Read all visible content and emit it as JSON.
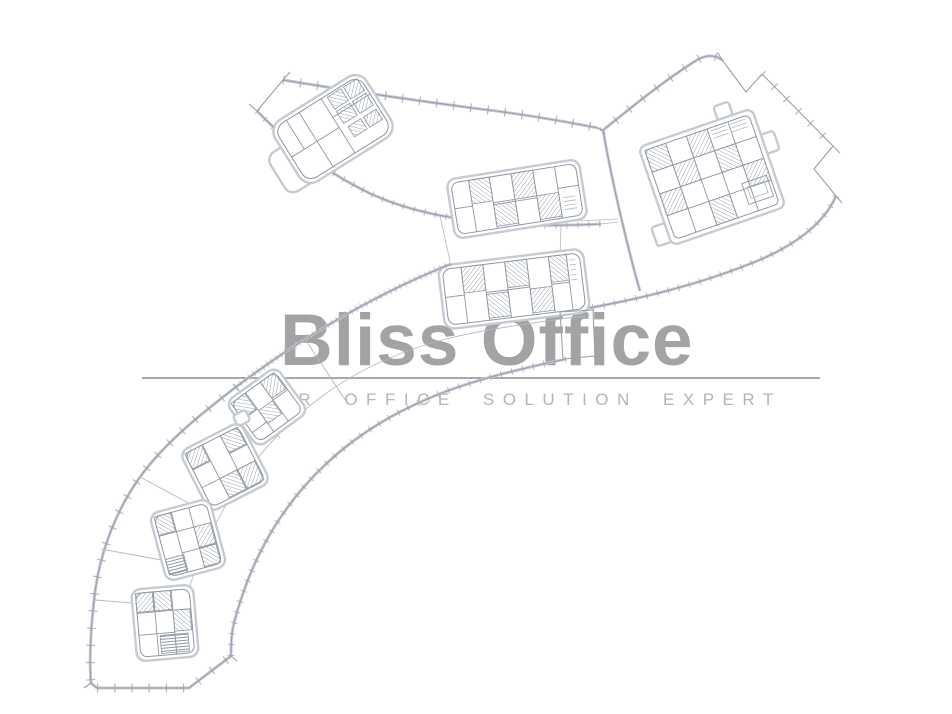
{
  "watermark": {
    "brand": "Bliss Office",
    "tagline": "YOUR OFFICE SOLUTION EXPERT"
  },
  "colors": {
    "brand-gray": "#9c9c9c",
    "tagline-gray": "#b5b5b5",
    "rule-gray": "#9a9a9a",
    "plan-line": "#9aa1ae",
    "plan-halo": "#c6cad2",
    "plan-dark": "#8f96a3",
    "plan-thin": "#b2b7c1",
    "background": "#ffffff"
  }
}
